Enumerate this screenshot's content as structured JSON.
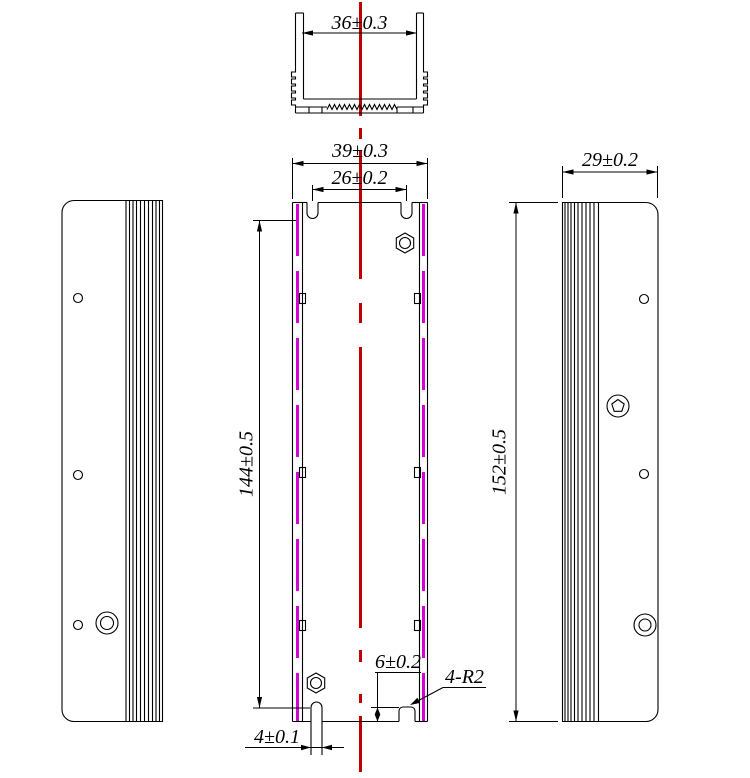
{
  "drawing": {
    "colors": {
      "line": "#000000",
      "centerline": "#C00000",
      "edge_highlight": "#D400D4",
      "background": "#FFFFFF"
    },
    "dimensions": {
      "top_inner_width": "36±0.3",
      "front_outer_width": "39±0.3",
      "top_slot_spacing": "26±0.2",
      "side_depth": "29±0.2",
      "front_inner_length": "144±0.5",
      "side_length": "152±0.5",
      "bottom_notch_height": "6±0.2",
      "notch_radius": "4-R2",
      "bottom_slot_width": "4±0.1"
    }
  }
}
